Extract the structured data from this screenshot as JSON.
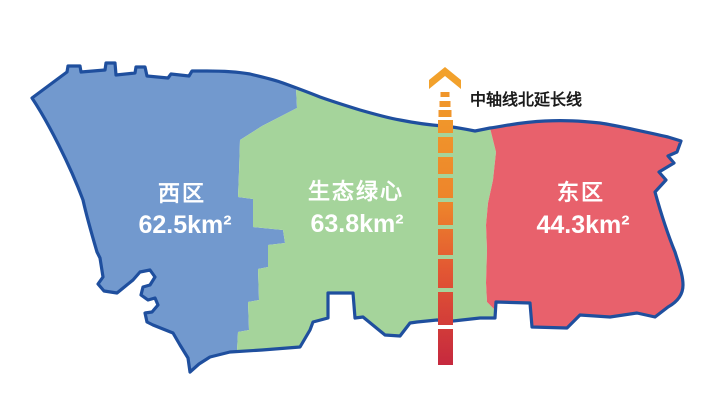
{
  "map": {
    "title": "regional-districts-map",
    "background": "#FFFFFF",
    "outline_color": "#1F4F9E",
    "label_text_color": "#FFFFFF",
    "regions": [
      {
        "id": "west",
        "name": "西区",
        "area": "62.5km²",
        "color": "#7299CE"
      },
      {
        "id": "green-heart",
        "name": "生态绿心",
        "area": "63.8km²",
        "color": "#A5D49B"
      },
      {
        "id": "east",
        "name": "东区",
        "area": "44.3km²",
        "color": "#E8616C"
      }
    ],
    "axis": {
      "label": "中轴线北延长线",
      "label_color": "#1A1A1A",
      "arrow_color": "#F2A12C",
      "dash_color": "#F0962B",
      "gradient": [
        "#F0962B",
        "#ED832B",
        "#E25633",
        "#C6293E"
      ]
    }
  }
}
